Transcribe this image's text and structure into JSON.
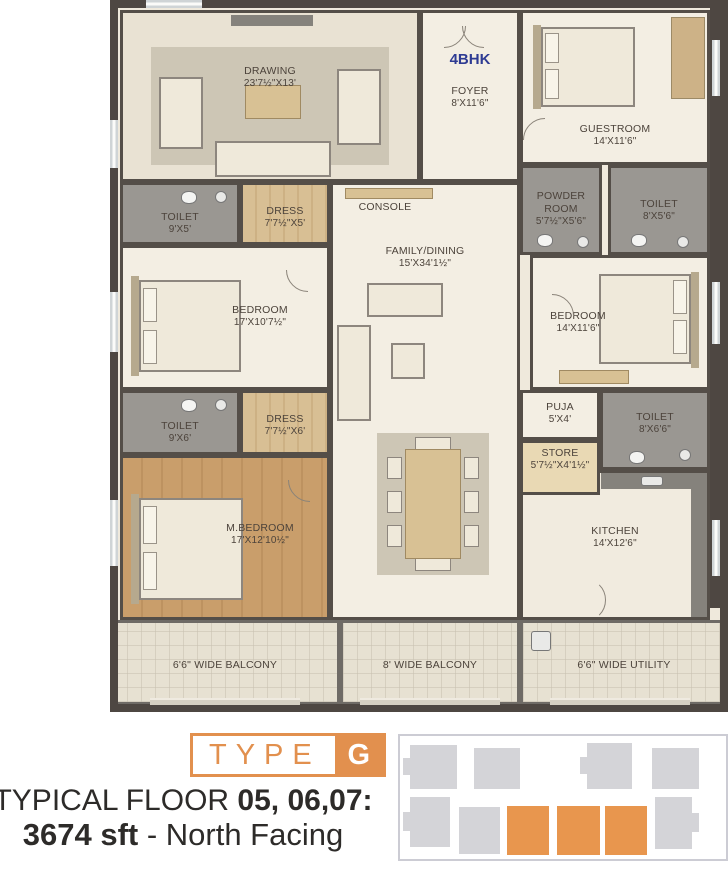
{
  "plan": {
    "unit_type": "4BHK",
    "rooms": {
      "drawing": {
        "name": "DRAWING",
        "dims": "23'7½\"X13'"
      },
      "foyer": {
        "name": "FOYER",
        "dims": "8'X11'6\""
      },
      "guestroom": {
        "name": "GUESTROOM",
        "dims": "14'X11'6\""
      },
      "powder_room": {
        "name": "POWDER ROOM",
        "dims": "5'7½\"X5'6\""
      },
      "toilet_guest": {
        "name": "TOILET",
        "dims": "8'X5'6\""
      },
      "toilet_bed1": {
        "name": "TOILET",
        "dims": "9'X5'"
      },
      "dress_bed1": {
        "name": "DRESS",
        "dims": "7'7½\"X5'"
      },
      "bedroom1": {
        "name": "BEDROOM",
        "dims": "17'X10'7½\""
      },
      "family_dining": {
        "name": "FAMILY/DINING",
        "dims": "15'X34'1½\""
      },
      "bedroom2": {
        "name": "BEDROOM",
        "dims": "14'X11'6\""
      },
      "toilet_master": {
        "name": "TOILET",
        "dims": "9'X6'"
      },
      "dress_master": {
        "name": "DRESS",
        "dims": "7'7½\"X6'"
      },
      "m_bedroom": {
        "name": "M.BEDROOM",
        "dims": "17'X12'10½\""
      },
      "puja": {
        "name": "PUJA",
        "dims": "5'X4'"
      },
      "store": {
        "name": "STORE",
        "dims": "5'7½\"X4'1½\""
      },
      "toilet_bed2": {
        "name": "TOILET",
        "dims": "8'X6'6\""
      },
      "kitchen": {
        "name": "KITCHEN",
        "dims": "14'X12'6\""
      },
      "balcony_left": {
        "name": "6'6\" WIDE BALCONY"
      },
      "balcony_center": {
        "name": "8' WIDE BALCONY"
      },
      "utility": {
        "name": "6'6\" WIDE UTILITY"
      }
    },
    "console_label": "CONSOLE"
  },
  "footer": {
    "type_word": "TYPE",
    "type_letter": "G",
    "line1_prefix": "TYPICAL FLOOR ",
    "line1_bold": "05, 06,07:",
    "line2_bold": "3674 sft",
    "line2_rest": "  - North Facing"
  },
  "colors": {
    "accent_orange": "#E8964E",
    "unit_label_blue": "#2E3B93",
    "wall": "#4E4742",
    "key_plan_gray": "#D4D4D8"
  }
}
